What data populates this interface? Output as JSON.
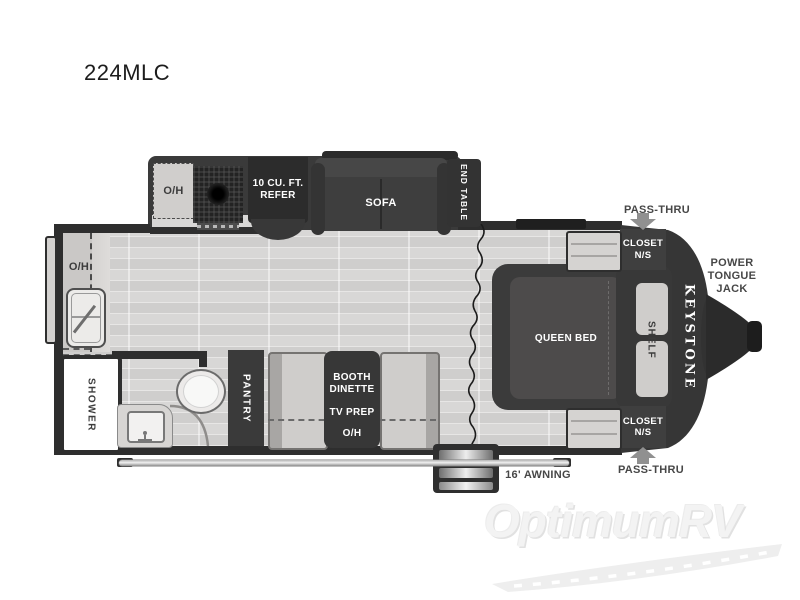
{
  "model": "224MLC",
  "watermark": "OptimumRV",
  "front_badge": "KEYSTONE",
  "exterior": {
    "pass_thru_top": "PASS-THRU",
    "pass_thru_bottom": "PASS-THRU",
    "power_tongue_jack": "POWER\nTONGUE\nJACK",
    "awning": "16' AWNING"
  },
  "kitchen": {
    "overhead": "O/H",
    "refrigerator": "10 CU. FT.\nREFER",
    "sofa": "SOFA",
    "end_table": "END TABLE"
  },
  "galley": {
    "overhead": "O/H"
  },
  "bathroom": {
    "shower": "SHOWER"
  },
  "pantry": {
    "label": "PANTRY"
  },
  "dinette": {
    "booth": "BOOTH\nDINETTE",
    "tv_prep": "TV PREP",
    "overhead": "O/H"
  },
  "bedroom": {
    "bed": "QUEEN BED",
    "shelf": "SHELF",
    "closet_top": "CLOSET\nN/S",
    "closet_bottom": "CLOSET\nN/S"
  },
  "colors": {
    "wall": "#2e2e2e",
    "furniture_dark": "#3a3a3a",
    "floor": "#d6d5d4",
    "cabinet_light": "#d0cecc",
    "label_on_dark": "#ffffff",
    "label_on_light": "#3f3f3f",
    "arrow_gray": "#909090"
  }
}
